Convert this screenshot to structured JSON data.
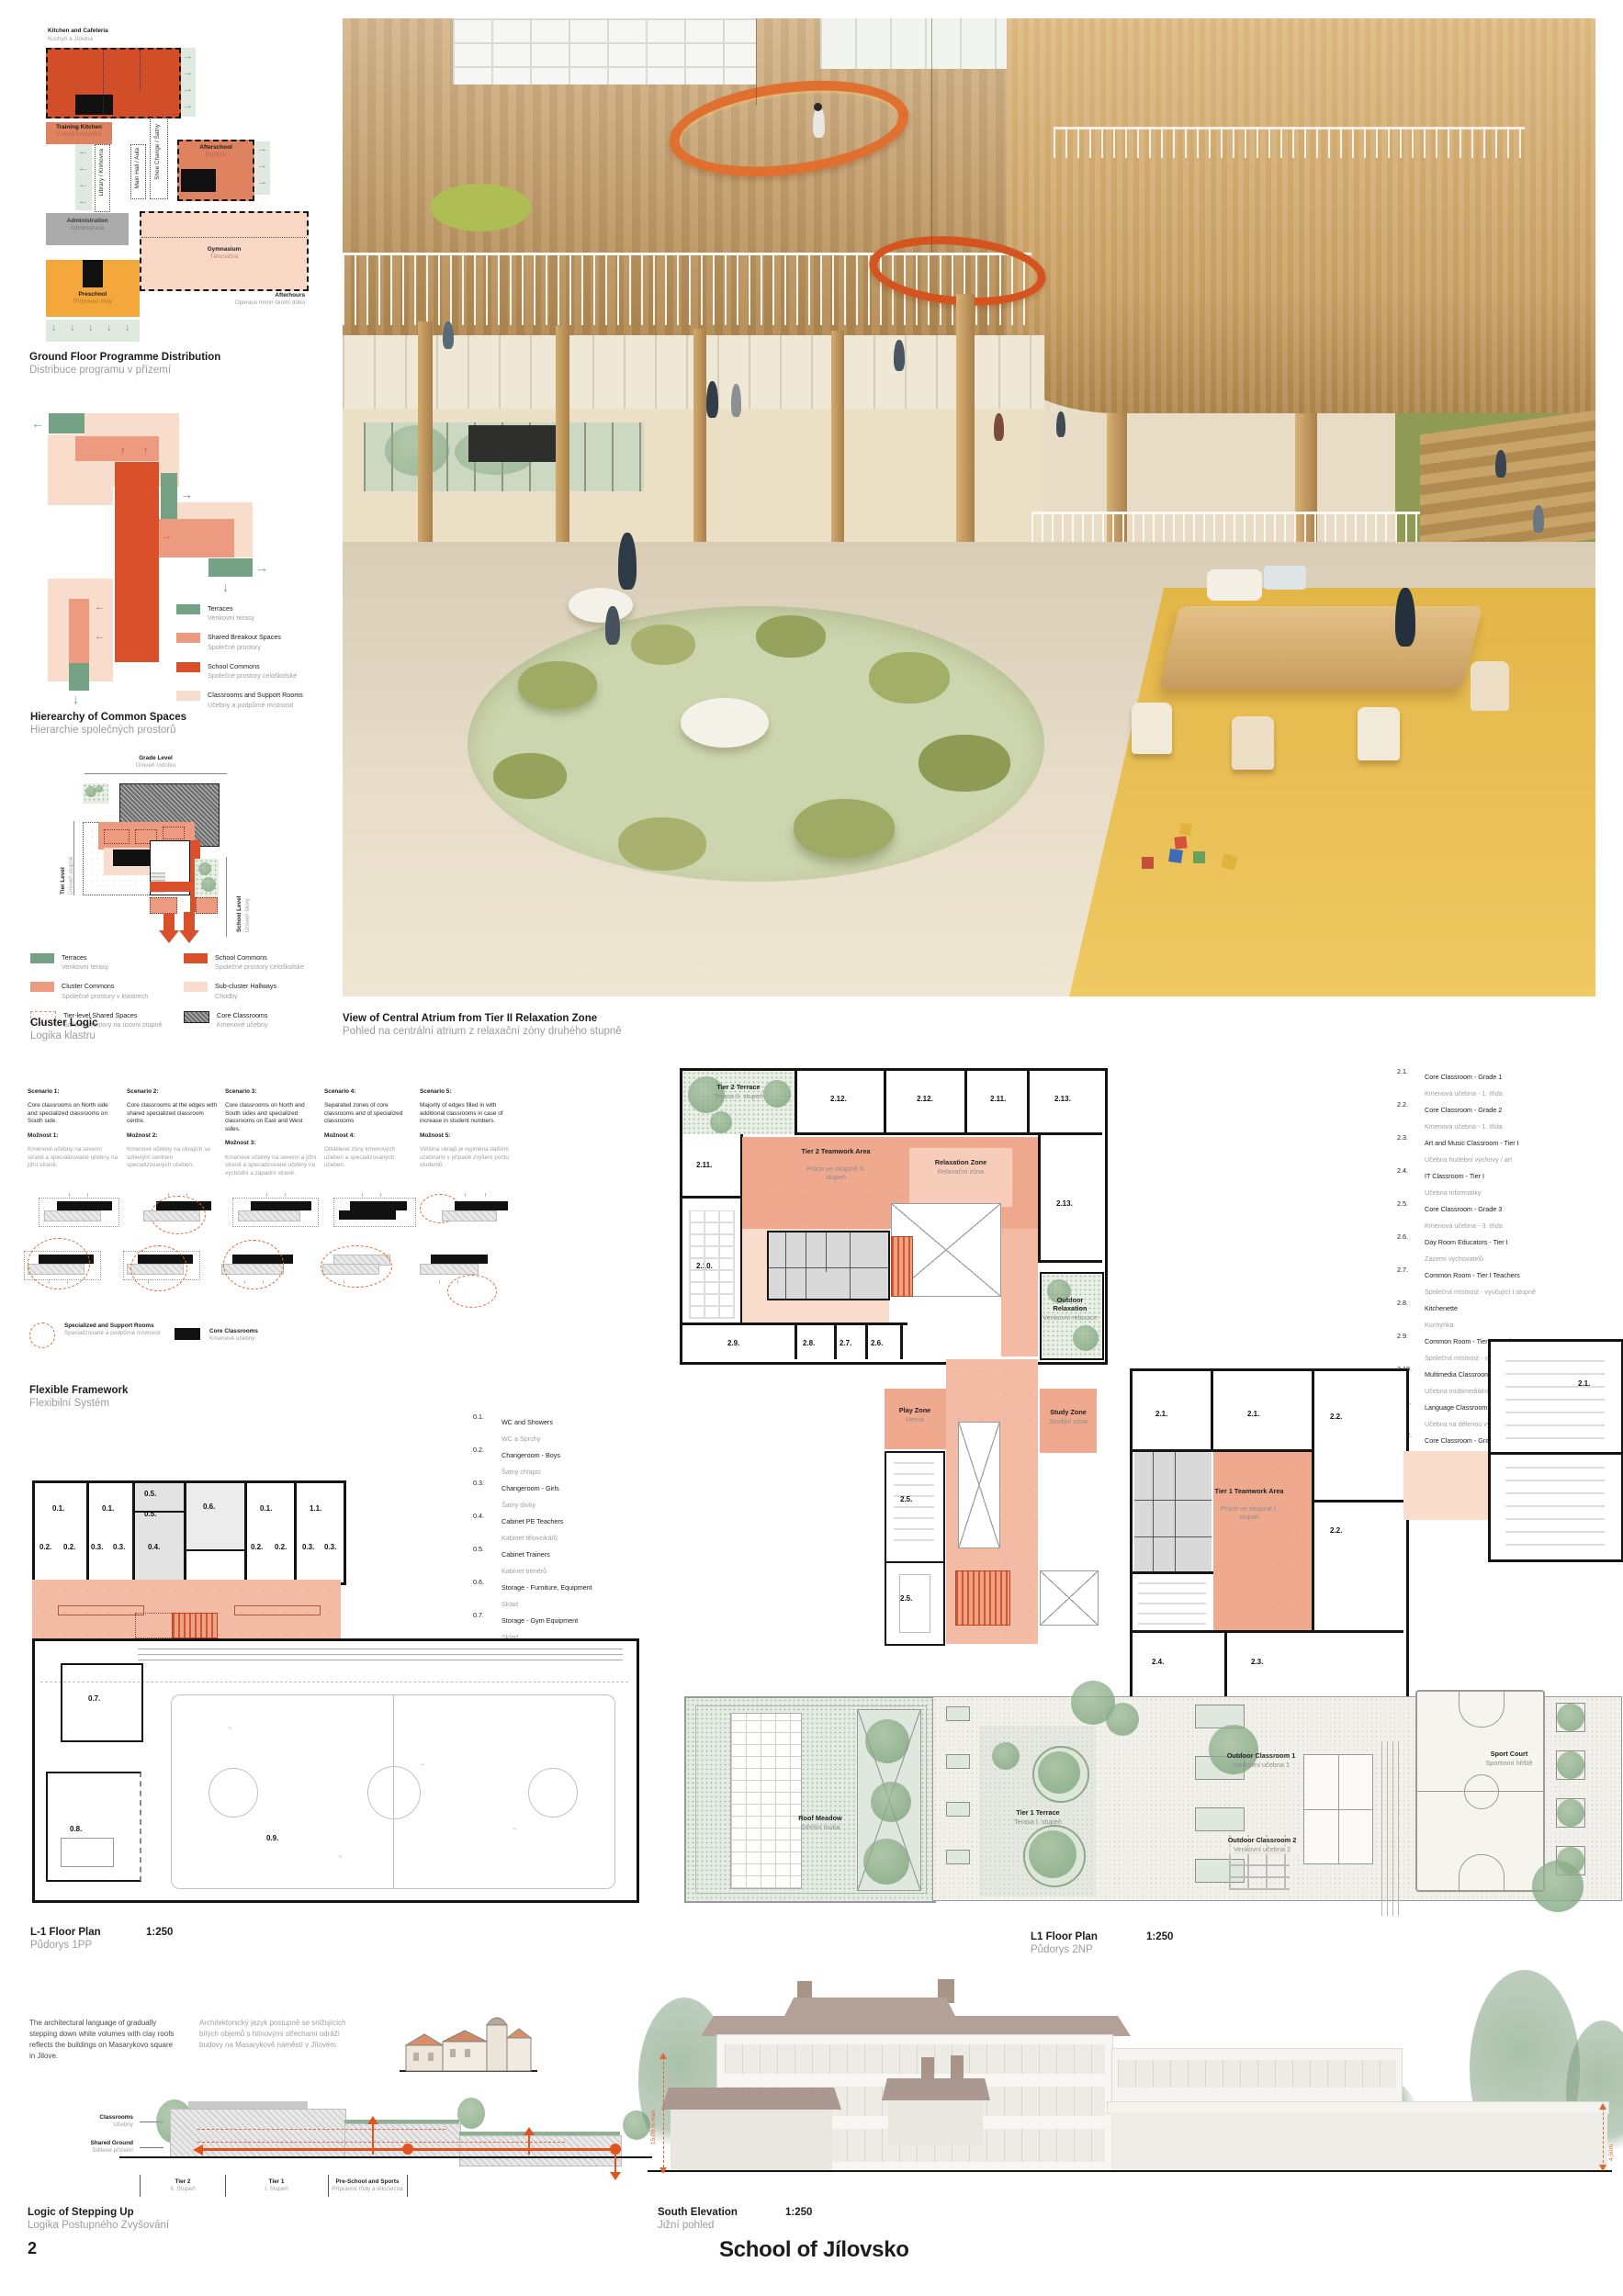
{
  "icons": {
    "arrow_right": "→",
    "arrow_left": "←",
    "arrow_up": "↑",
    "arrow_down": "↓"
  },
  "colors": {
    "accent_orange": "#d9502a",
    "salmon": "#efa98f",
    "pale_pink": "#f8dccb",
    "terrace_green": "#75a284",
    "preschool_yellow": "#f2a93c",
    "admin_gray": "#ababab"
  },
  "page": {
    "number": "2",
    "title": "School of Jílovsko"
  },
  "programme": {
    "caption_en": "Ground Floor Programme Distribution",
    "caption_cz": "Distribuce programu v přízemí",
    "kitchen_en": "Kitchen and Cafeteria",
    "kitchen_cz": "Kuchyň a Jídelna",
    "training_en": "Training Kitchen",
    "training_cz": "Cvičná kuchyňka",
    "library": "Library / Knihovna",
    "mainhall": "Main Hall / Aula",
    "shoe": "Shoe Change / Šatny",
    "afterschool_en": "Afterschool",
    "afterschool_cz": "Družina",
    "admin_en": "Administration",
    "admin_cz": "Administrace",
    "gym_en": "Gymnasium",
    "gym_cz": "Tělocvična",
    "preschool_en": "Preschool",
    "preschool_cz": "Přípravné třídy",
    "afterhours_en": "Afterhours",
    "afterhours_cz": "Operace mimo školní dobu"
  },
  "hierarchy": {
    "caption_en": "Hierearchy of Common Spaces",
    "caption_cz": "Hierarchie společných prostorů",
    "legend": [
      {
        "en": "Terraces",
        "cz": "Venkovní terasy"
      },
      {
        "en": "Shared Breakout Spaces",
        "cz": "Společné prostory"
      },
      {
        "en": "School Commons",
        "cz": "Společné prostory celoškolské"
      },
      {
        "en": "Classrooms and Support Rooms",
        "cz": "Učebny a podpůrné místnosti"
      }
    ]
  },
  "cluster": {
    "caption_en": "Cluster Logic",
    "caption_cz": "Logika klastru",
    "grade_en": "Grade Level",
    "grade_cz": "Úroveň ročníku",
    "tier_en": "Tier Level",
    "tier_cz": "Úroveň stupně",
    "school_en": "School Level",
    "school_cz": "Úroveň školy",
    "legend": [
      {
        "en": "Terraces",
        "cz": "Venkovní terasy"
      },
      {
        "en": "Cluster Commons",
        "cz": "Společné prostory v klastrech"
      },
      {
        "en": "Tier-level Shared Spaces",
        "cz": "Sdílené prostory na úrovni stupně"
      },
      {
        "en": "School Commons",
        "cz": "Společné prostory celoškolské"
      },
      {
        "en": "Sub-cluster Hallways",
        "cz": "Chodby"
      },
      {
        "en": "Core Classrooms",
        "cz": "Kmenové učebny"
      }
    ]
  },
  "render": {
    "caption_en": "View of Central Atrium from Tier II Relaxation Zone",
    "caption_cz": "Pohled na centrální atrium z relaxační zóny druhého stupně"
  },
  "scenarios": [
    {
      "n": "Scenario 1:",
      "en": "Core classrooms on North side and specialized classrooms on South side.",
      "m": "Možnost 1:",
      "cz": "Kmenové učebny na severní straně a specializované učebny na jižní straně."
    },
    {
      "n": "Scenario 2:",
      "en": "Core classrooms at the edges with shared specialized classroom centre.",
      "m": "Možnost 2:",
      "cz": "Kmenové učebny na okrajích se sdíleným centrem specializovaných učeben."
    },
    {
      "n": "Scenario 3:",
      "en": "Core classrooms on North and South sides and specialized classrooms on East and West sides.",
      "m": "Možnost 3:",
      "cz": "Kmenové učebny na severní a jižní straně a specializované učebny na východní a západní straně."
    },
    {
      "n": "Scenario 4:",
      "en": "Separated zones of core classrooms and of specialized classrooms",
      "m": "Možnost 4:",
      "cz": "Oddělené zóny kmenových učeben a specializovaných učeben."
    },
    {
      "n": "Scenario 5:",
      "en": "Majority of edges filled in with additional classrooms in case of increase in student numbers.",
      "m": "Možnost 5:",
      "cz": "Většina okrajů je vyplněna dalšími učebnami v případě zvýšení počtu studentů."
    }
  ],
  "flexible": {
    "caption_en": "Flexible Framework",
    "caption_cz": "Flexibilní Systém",
    "legend1_en": "Specialized and Support Rooms",
    "legend1_cz": "Specializované a podpůrné místnosti",
    "legend2_en": "Core Classrooms",
    "legend2_cz": "Kmenové učebny"
  },
  "rooms0": [
    {
      "num": "0.1.",
      "en": "WC and Showers",
      "cz": "WC a Sprchy"
    },
    {
      "num": "0.2.",
      "en": "Changeroom - Boys",
      "cz": "Šatny chlapci"
    },
    {
      "num": "0.3.",
      "en": "Changeroom - Girls",
      "cz": "Šatny dívky"
    },
    {
      "num": "0.4.",
      "en": "Cabinet PE Teachers",
      "cz": "Kabinet tělovcikářů"
    },
    {
      "num": "0.5.",
      "en": "Cabinet Trainers",
      "cz": "Kabinet trenérů"
    },
    {
      "num": "0.6.",
      "en": "Storage - Furniture, Equipment",
      "cz": "Sklad"
    },
    {
      "num": "0.7.",
      "en": "Storage - Gym Equipment",
      "cz": "Sklad"
    },
    {
      "num": "0.8.",
      "en": "Gymnastics / Multipurpose Hall",
      "cz": "Gymnastický / Víceúčelový sál"
    },
    {
      "num": "0.9.",
      "en": "Sports Hall",
      "cz": "Tělocvična"
    }
  ],
  "rooms2": [
    {
      "num": "2.1.",
      "en": "Core Classroom - Grade 1",
      "cz": "Kmenová učebna - 1. třída"
    },
    {
      "num": "2.2.",
      "en": "Core Classroom - Grade 2",
      "cz": "Kmenová učebna - 1. třída"
    },
    {
      "num": "2.3.",
      "en": "Art and Music Classroom - Tier I",
      "cz": "Učebna hudební výchovy / art"
    },
    {
      "num": "2.4.",
      "en": "IT Classroom - Tier I",
      "cz": "Učebna informatiky"
    },
    {
      "num": "2.5.",
      "en": "Core Classroom - Grade 3",
      "cz": "Kmenová učebna - 3. třída"
    },
    {
      "num": "2.6.",
      "en": "Day Room Educators - Tier I",
      "cz": "Zázemí vychovatelů"
    },
    {
      "num": "2.7.",
      "en": "Common Room - Tier I Teachers",
      "cz": "Společná místnost - vyučující I.stupně"
    },
    {
      "num": "2.8.",
      "en": "Kitchenette",
      "cz": "Kuchyňka"
    },
    {
      "num": "2.9.",
      "en": "Common Room - Tier II Teachers",
      "cz": "Společná místnost - vyučující II.stupně"
    },
    {
      "num": "2.10.",
      "en": "Multimedia Classroom",
      "cz": "Učebna multimediální výchovy"
    },
    {
      "num": "2.11.",
      "en": "Language Classroom",
      "cz": "Učebna na dělenou výuku / jazyky"
    },
    {
      "num": "2.12.",
      "en": "Core Classroom - Grade 6",
      "cz": "Kmenová učebna - 6. třída"
    },
    {
      "num": "2.13.",
      "en": "Core Classroom - Grade 7",
      "cz": "Kmenová učebna - 7. třída"
    }
  ],
  "plan_l1m": {
    "caption_en": "L-1 Floor Plan",
    "caption_cz": "Půdorys 1PP",
    "scale": "1:250",
    "labels": [
      "0.1.",
      "0.1.",
      "0.5.",
      "0.5.",
      "0.6.",
      "0.1.",
      "1.1.",
      "0.2.",
      "0.2.",
      "0.3.",
      "0.3.",
      "0.4.",
      "0.2.",
      "0.2.",
      "0.3.",
      "0.3.",
      "0.7.",
      "0.8.",
      "0.9."
    ]
  },
  "plan_l1": {
    "caption_en": "L1 Floor Plan",
    "caption_cz": "Půdorys 2NP",
    "scale": "1:250",
    "labels": [
      "2.12.",
      "2.12.",
      "2.11.",
      "2.13.",
      "2.11.",
      "2.10.",
      "2.13.",
      "2.9.",
      "2.8.",
      "2.7.",
      "2.6.",
      "2.5.",
      "2.5.",
      "2.1.",
      "2.1.",
      "2.2.",
      "2.2.",
      "2.4.",
      "2.3.",
      "2.1."
    ],
    "zones": {
      "tier2_terrace_en": "Tier 2 Terrace",
      "tier2_terrace_cz": "Terasa II. stupeň",
      "tier2_teamwork_en": "Tier 2 Teamwork Area",
      "tier2_teamwork_cz": "Práce ve skupině II. stupeň",
      "relaxation_en": "Relaxation Zone",
      "relaxation_cz": "Relaxační zóna",
      "outdoor_relax_en": "Outdoor Relaxation",
      "outdoor_relax_cz": "Venkovní relaxace",
      "play_en": "Play Zone",
      "play_cz": "Herna",
      "study_en": "Study Zone",
      "study_cz": "Studijní zóna",
      "tier1_teamwork_en": "Tier 1 Teamwork Area",
      "tier1_teamwork_cz": "Práce ve skupině I. stupeň",
      "roof_meadow_en": "Roof Meadow",
      "roof_meadow_cz": "Střešní louka",
      "tier1_terrace_en": "Tier 1 Terrace",
      "tier1_terrace_cz": "Terasa I. stupeň",
      "outdoor_class1_en": "Outdoor Classroom 1",
      "outdoor_class1_cz": "Venkovní učebna 1",
      "outdoor_class2_en": "Outdoor Classroom 2",
      "outdoor_class2_cz": "Venkovní učebna 2",
      "sport_en": "Sport Court",
      "sport_cz": "Sportovní hřiště"
    }
  },
  "stepping": {
    "text_en": "The architectural language of gradually stepping down white volumes with clay roofs reflects the buildings on Masarykovo square in Jilove.",
    "text_cz": "Architektonický jazyk postupně se snižujících bílých objemů s hlínovými střechami odráží budovy na Masarykově náměstí v Jílovém.",
    "classrooms_en": "Classrooms",
    "classrooms_cz": "Učebny",
    "shared_en": "Shared Ground",
    "shared_cz": "Sdílené přízemí",
    "tiers": [
      {
        "en": "Tier 2",
        "cz": "II. Stupeň"
      },
      {
        "en": "Tier 1",
        "cz": "I. Stupeň"
      },
      {
        "en": "Pre-School and Sports",
        "cz": "Přípravné třídy a tělocvična"
      }
    ],
    "caption_en": "Logic of Stepping Up",
    "caption_cz": "Logika Postupného Zvyšování"
  },
  "elevation": {
    "caption_en": "South Elevation",
    "caption_cz": "Jižní pohled",
    "scale": "1:250",
    "dim_left": "15,00 m max",
    "dim_right": "4,50m"
  }
}
